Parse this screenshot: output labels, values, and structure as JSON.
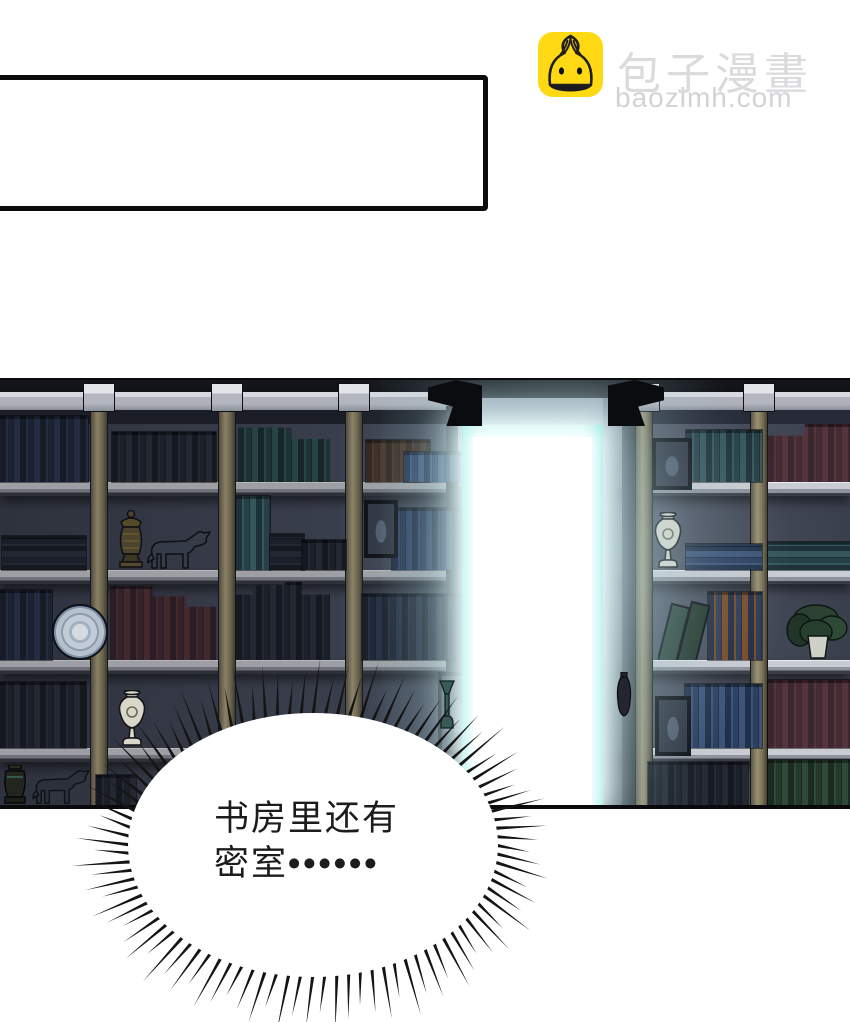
{
  "logo": {
    "site_name": "包子漫畫",
    "site_domain": "baozimh.com",
    "icon": "steamed-bun-icon"
  },
  "caption_box": {
    "text": ""
  },
  "bubble": {
    "line1": "书房里还有",
    "line2_prefix": "密室",
    "line2_dots": "••••••",
    "full_text": "书房里还有密室……"
  },
  "scene": {
    "objects": [
      "bookshelves",
      "glowing-secret-door",
      "horse-statuettes",
      "white-urns",
      "bronze-urn",
      "decorative-plate",
      "potted-plant",
      "picture-frames",
      "books"
    ]
  },
  "colors": {
    "brand_yellow": "#FFD913",
    "logo_text": "#DADBDD",
    "logo_domain_text": "#D2D3D6",
    "door_cyan": "#8FEDE5",
    "door_core": "#FFFFFF",
    "panel_bg": "#3A3F4B",
    "wall": "#7E8494",
    "shelf_back": "#454A58",
    "board": "#C3C6CC",
    "pillar": "#857D60",
    "bubble_fill": "#FFFFFF",
    "spike": "#141414",
    "text": "#1C1C1C",
    "caption_border": "#0C0C0C"
  }
}
